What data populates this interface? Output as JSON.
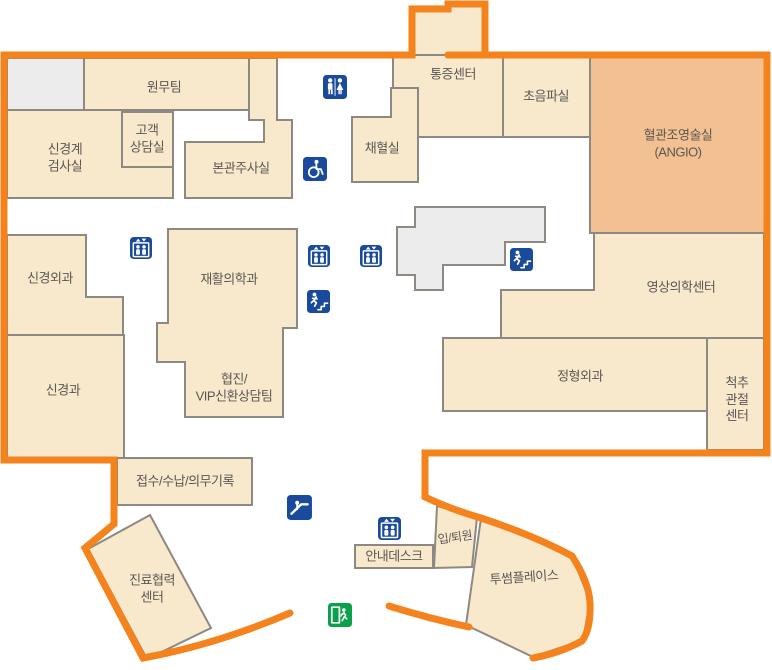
{
  "map": {
    "type": "hospital-floor-map",
    "colors": {
      "border_orange": "#F5831D",
      "room_fill": "#F8E9CD",
      "angio_fill": "#F3C191",
      "neutral_fill": "#ECECEC",
      "wall_gray": "#8D8982",
      "icon_blue": "#1A4A9C",
      "exit_green": "#0AA14A",
      "label_text": "#5B5752"
    },
    "rooms": {
      "wonmu": {
        "label": "원무팀"
      },
      "singyeonggye_geomsasil": {
        "label": "신경계\n검사실"
      },
      "gogaek_sangdamsil": {
        "label": "고객\n상담실"
      },
      "bongwan_jusasil": {
        "label": "본관주사실"
      },
      "chaehyeolsil": {
        "label": "채혈실"
      },
      "tongjeung_center": {
        "label": "통증센터"
      },
      "choeumpasil": {
        "label": "초음파실"
      },
      "angio": {
        "label": "혈관조영술실\n(ANGIO)"
      },
      "singyeong_oegwa": {
        "label": "신경외과"
      },
      "jaehwal_uihakgwa": {
        "label": "재활의학과"
      },
      "singyeonggwa": {
        "label": "신경과"
      },
      "hyeopjin_vip": {
        "label": "협진/\nVIP신환상담팀"
      },
      "yeongsang_center": {
        "label": "영상의학센터"
      },
      "jeonghyeong_oegwa": {
        "label": "정형외과"
      },
      "cheokchu_gwanjeol_center": {
        "label": "척추\n관절\n센터"
      },
      "jeopsu_sunap": {
        "label": "접수/수납/의무기록"
      },
      "jinryo_hyeopryeok_center": {
        "label": "진료협력\n센터"
      },
      "annae_desk": {
        "label": "안내데스크"
      },
      "ip_toewon": {
        "label": "입/퇴원"
      },
      "twosome_place": {
        "label": "투썸플레이스"
      }
    },
    "icons": [
      {
        "name": "restroom-icon",
        "count": 1
      },
      {
        "name": "wheelchair-icon",
        "count": 1
      },
      {
        "name": "elevator-icon",
        "count": 4
      },
      {
        "name": "stairs-icon",
        "count": 2
      },
      {
        "name": "escalator-icon",
        "count": 1
      },
      {
        "name": "emergency-exit-icon",
        "count": 1
      }
    ]
  }
}
